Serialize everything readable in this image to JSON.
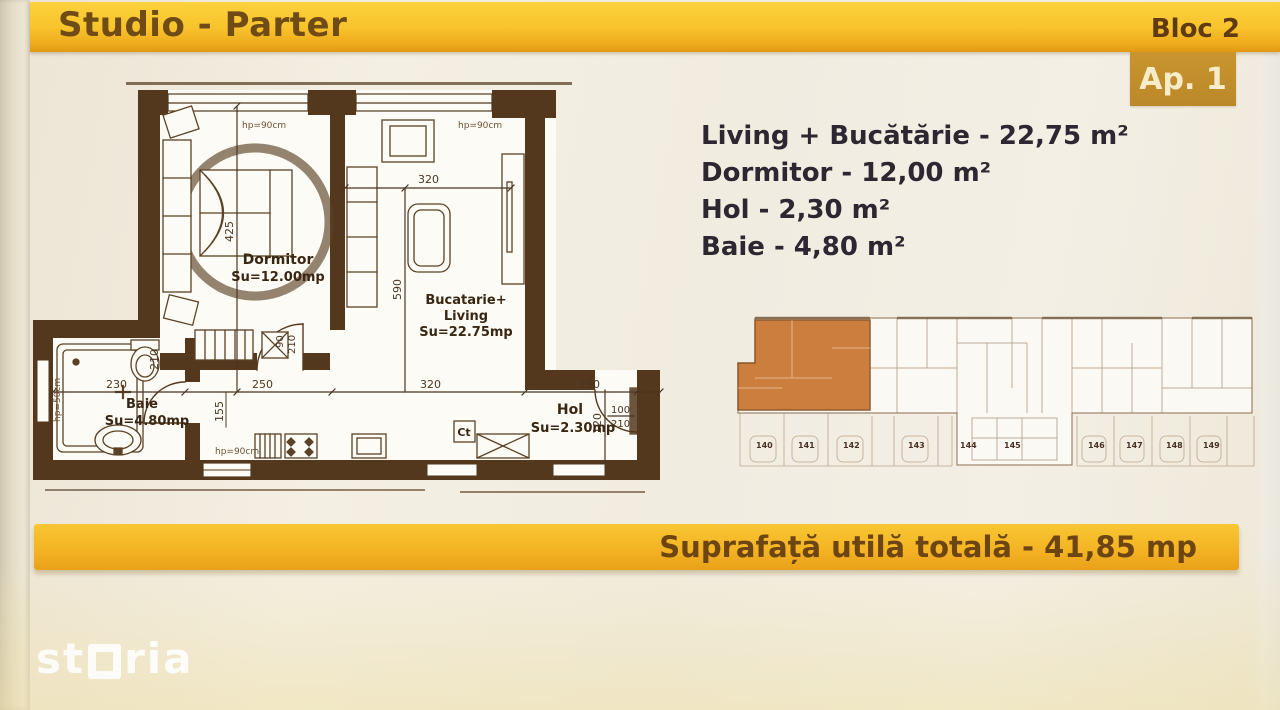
{
  "header": {
    "title": "Studio - Parter",
    "bloc_label": "Bloc 2",
    "apartment_label": "Ap. 1"
  },
  "area_list": {
    "items": [
      "Living + Bucătărie - 22,75 m²",
      "Dormitor - 12,00 m²",
      "Hol - 2,30 m²",
      "Baie - 4,80 m²"
    ]
  },
  "footer": {
    "total_area_label": "Suprafață utilă totală - 41,85 mp"
  },
  "watermark": {
    "st": "st",
    "ria": "ria",
    "full": "storia"
  },
  "floor_plan": {
    "rooms": {
      "dormitor": {
        "name": "Dormitor",
        "area": "Su=12.00mp"
      },
      "living": {
        "line1": "Bucatarie+",
        "line2": "Living",
        "area": "Su=22.75mp"
      },
      "baie": {
        "name": "Baie",
        "area": "Su=4.80mp"
      },
      "hol": {
        "name": "Hol",
        "area": "Su=2.30mp"
      }
    },
    "dimensions": {
      "dorm_height": "425",
      "living_width_top": "320",
      "living_height": "590",
      "baie_width": "230",
      "baie_height": "210",
      "hall_width": "250",
      "kitchen_width": "320",
      "hol_width": "190",
      "dim_155": "155",
      "dim_120": "120"
    },
    "doors": {
      "dorm_door_w": "90",
      "dorm_door_h": "210",
      "entry_door_w": "100",
      "entry_door_h": "210"
    },
    "windows": {
      "win1": "hp=90cm",
      "win2": "hp=90cm",
      "win3": "hp=90cm",
      "shower_win": "hp=50cm"
    },
    "boiler": "Ct"
  },
  "site_plan": {
    "parking_numbers": [
      "140",
      "141",
      "142",
      "143",
      "144",
      "145",
      "146",
      "147",
      "148",
      "149"
    ]
  },
  "colors": {
    "banner_yellow": "#f7c22a",
    "banner_dark": "#e59f18",
    "banner_text": "#6f4b16",
    "badge_bg": "#c3912d",
    "badge_text": "#f6ecca",
    "plan_ink": "#53381e",
    "unit_highlight": "#c9742f",
    "list_text": "#2c2730"
  }
}
